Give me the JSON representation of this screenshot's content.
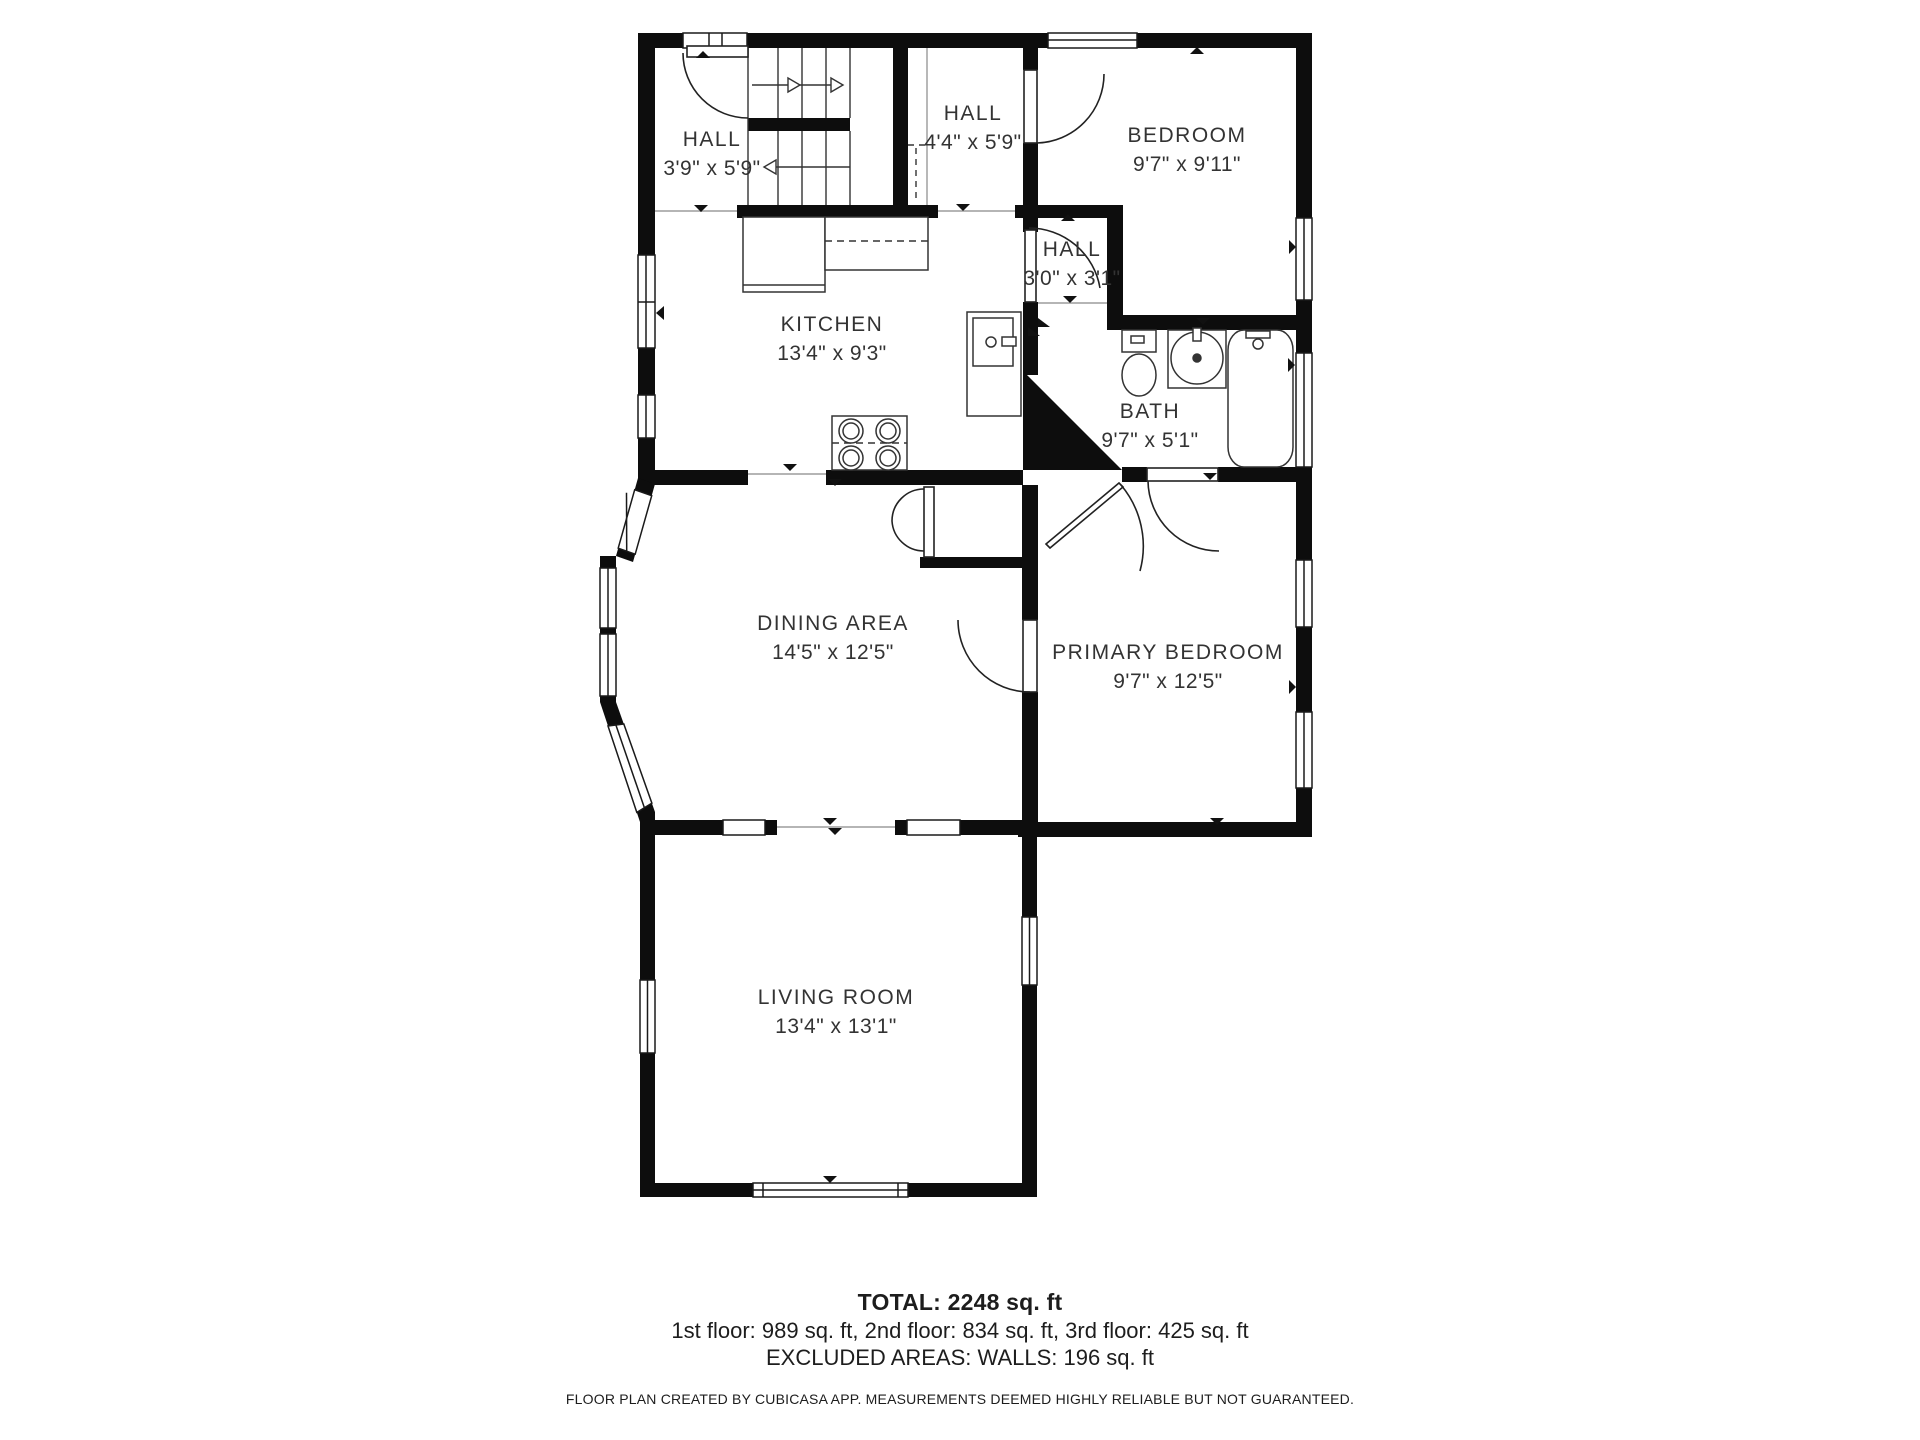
{
  "rooms": [
    {
      "id": "hall-top-left",
      "name": "HALL",
      "dims": "3'9\" x 5'9\""
    },
    {
      "id": "hall-top-mid",
      "name": "HALL",
      "dims": "4'4\" x 5'9\""
    },
    {
      "id": "bedroom",
      "name": "BEDROOM",
      "dims": "9'7\" x 9'11\""
    },
    {
      "id": "hall-small",
      "name": "HALL",
      "dims": "3'0\" x 3'1\""
    },
    {
      "id": "kitchen",
      "name": "KITCHEN",
      "dims": "13'4\" x 9'3\""
    },
    {
      "id": "bath",
      "name": "BATH",
      "dims": "9'7\" x 5'1\""
    },
    {
      "id": "dining",
      "name": "DINING AREA",
      "dims": "14'5\" x 12'5\""
    },
    {
      "id": "primary",
      "name": "PRIMARY BEDROOM",
      "dims": "9'7\" x 12'5\""
    },
    {
      "id": "living",
      "name": "LIVING ROOM",
      "dims": "13'4\" x 13'1\""
    }
  ],
  "summary": {
    "total": "TOTAL: 2248 sq. ft",
    "floors": "1st floor: 989 sq. ft, 2nd floor: 834 sq. ft, 3rd floor: 425 sq. ft",
    "excluded": "EXCLUDED AREAS: WALLS: 196 sq. ft",
    "credit": "FLOOR PLAN CREATED BY CUBICASA APP. MEASUREMENTS DEEMED HIGHLY RELIABLE BUT NOT GUARANTEED."
  },
  "icons": [
    "staircase-icon",
    "stove-icon",
    "refrigerator-icon",
    "kitchen-counter-icon",
    "toilet-icon",
    "sink-icon",
    "bathtub-icon",
    "window",
    "door-arc"
  ],
  "colors": {
    "wall": "#0d0d0d",
    "line": "#222222",
    "lightline": "#bbbbbb",
    "text": "#333333"
  }
}
